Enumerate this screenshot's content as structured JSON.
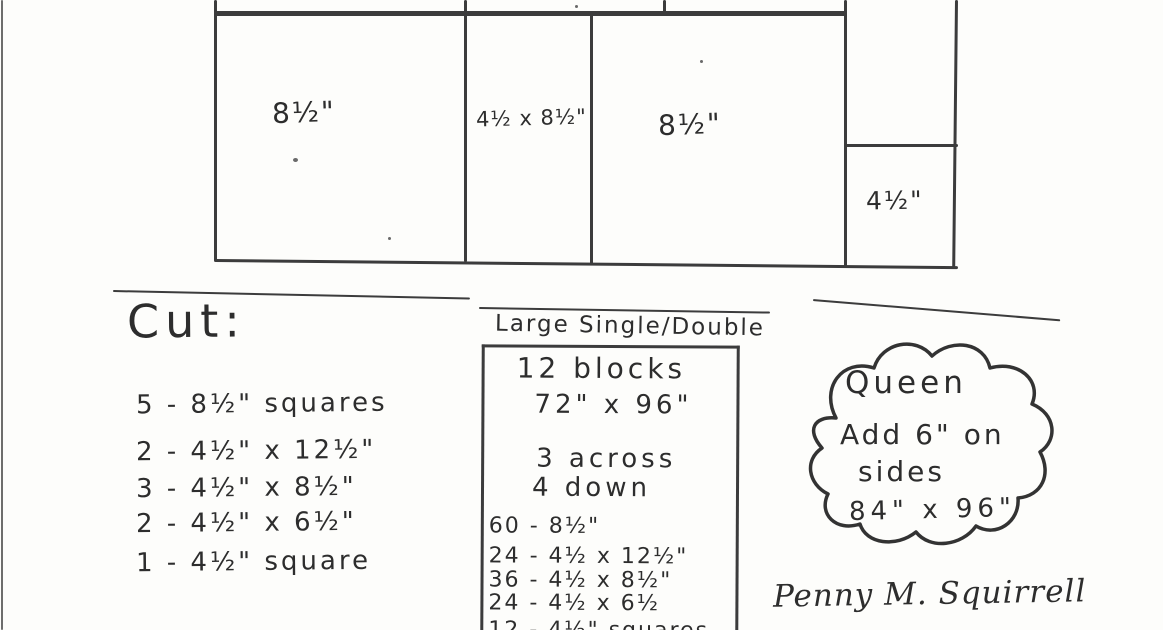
{
  "page": {
    "background": "#fdfdfb",
    "ink": "#3c3c3c",
    "handwriting_color": "#2d2d2d",
    "description": "Scanned hand-drawn quilt block pattern sheet"
  },
  "diagram": {
    "cells": [
      {
        "label": "8½\""
      },
      {
        "label": "4½ x 8½\""
      },
      {
        "label": "8½\""
      },
      {
        "label": "4½\""
      }
    ]
  },
  "cut_list": {
    "heading": "Cut:",
    "items": [
      "5 - 8½\" squares",
      "2 - 4½\" x 12½\"",
      "3 - 4½\" x 8½\"",
      "2 - 4½\" x 6½\"",
      "1 - 4½\" square"
    ]
  },
  "size_box": {
    "title": "Large Single/Double",
    "summary": [
      "12 blocks",
      "72\" x 96\"",
      "3 across",
      "4 down"
    ],
    "counts": [
      "60 - 8½\"",
      "24 - 4½ x 12½\"",
      "36 - 4½ x 8½\"",
      "24 - 4½ x 6½",
      "12 - 4½\" squares"
    ]
  },
  "queen_note": {
    "lines": [
      "Queen",
      "Add 6\" on",
      "sides",
      "84\" x 96\""
    ]
  },
  "signature": "Penny M. Squirrell"
}
